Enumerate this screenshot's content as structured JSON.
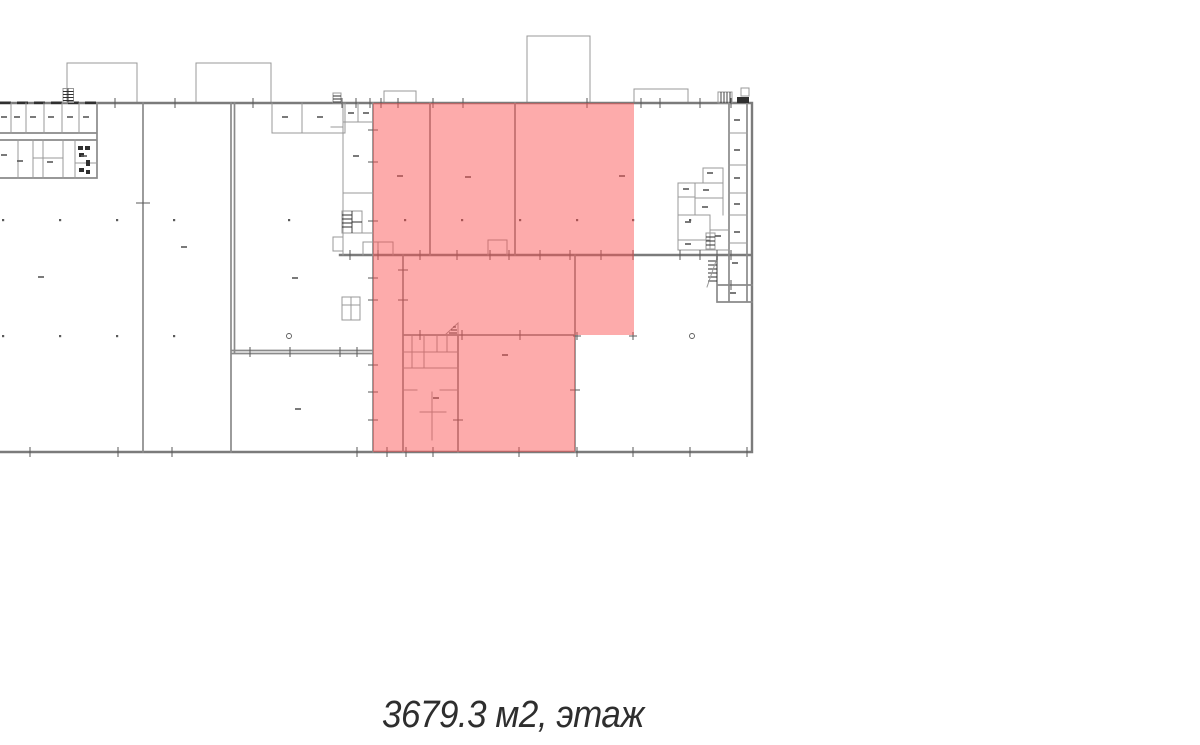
{
  "theme": {
    "page-bg": "#ffffff",
    "wall": "#8a8a8a",
    "wall-strong": "#7b7b7b",
    "wall-thin": "#989898",
    "detail": "#2f2f2f",
    "marker": "#5a5a5a",
    "caption-color": "#2e2e2e",
    "highlight": "rgba(250,80,80,0.48)"
  },
  "highlight": {
    "rgba": "rgba(250,80,80,0.48)",
    "visible_hex_over_white": "#fcacac"
  },
  "caption": {
    "text": "3679.3 м2, этаж",
    "area_value": "3679.3",
    "area_unit": "м2",
    "floor_word": "этаж"
  }
}
